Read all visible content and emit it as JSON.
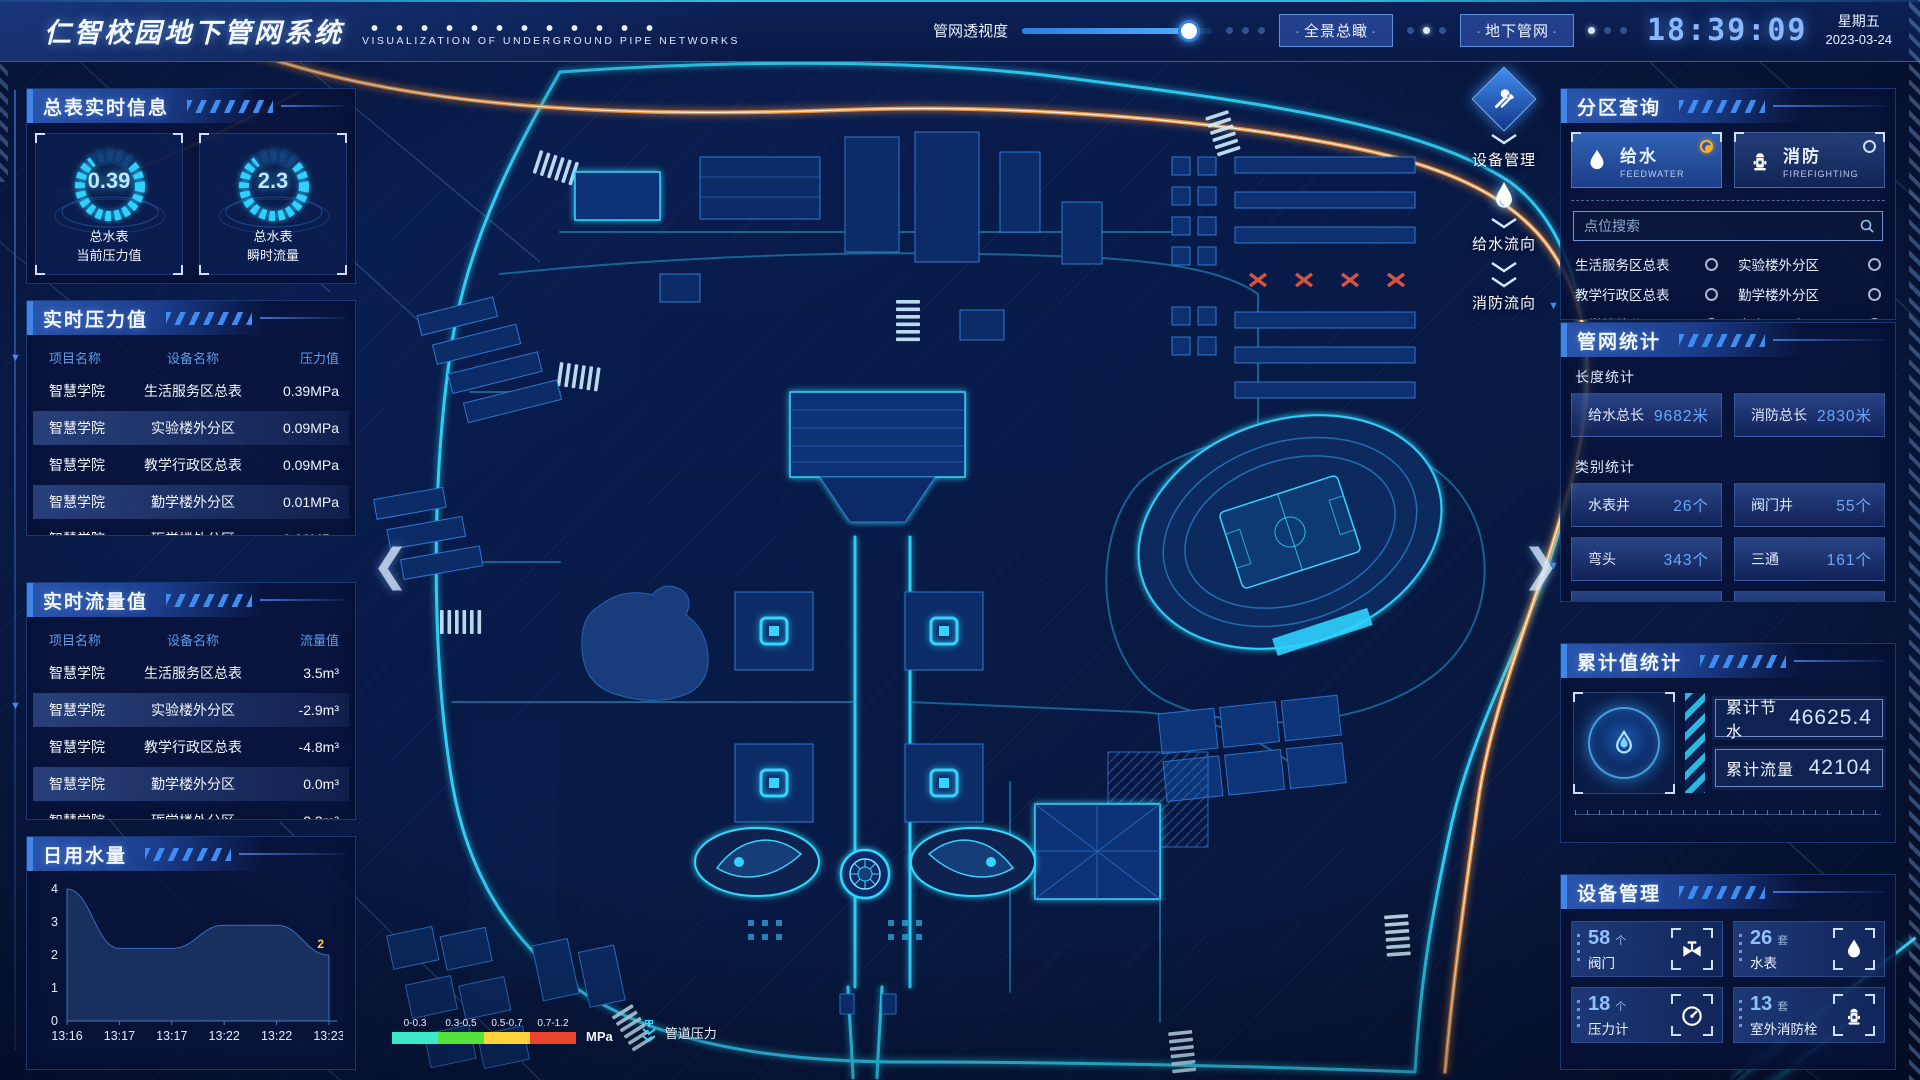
{
  "header": {
    "title": "仁智校园地下管网系统",
    "subtitle": "VISUALIZATION OF UNDERGROUND PIPE NETWORKS",
    "slider_label": "管网透视度",
    "slider_percent": 88,
    "buttons": {
      "panorama": "全景总瞰",
      "underground": "地下管网"
    },
    "clock": "18:39:09",
    "weekday": "星期五",
    "date": "2023-03-24"
  },
  "left": {
    "meters": {
      "title": "总表实时信息",
      "gauges": [
        {
          "value": "0.39",
          "label1": "总水表",
          "label2": "当前压力值"
        },
        {
          "value": "2.3",
          "label1": "总水表",
          "label2": "瞬时流量"
        }
      ]
    },
    "pressure": {
      "title": "实时压力值",
      "headers": [
        "项目名称",
        "设备名称",
        "压力值"
      ],
      "rows": [
        [
          "智慧学院",
          "生活服务区总表",
          "0.39MPa"
        ],
        [
          "智慧学院",
          "实验楼外分区",
          "0.09MPa"
        ],
        [
          "智慧学院",
          "教学行政区总表",
          "0.09MPa"
        ],
        [
          "智慧学院",
          "勤学楼外分区",
          "0.01MPa"
        ],
        [
          "智慧学院",
          "砺学楼外分区",
          "0.00MPa"
        ]
      ]
    },
    "flow": {
      "title": "实时流量值",
      "headers": [
        "项目名称",
        "设备名称",
        "流量值"
      ],
      "rows": [
        [
          "智慧学院",
          "生活服务区总表",
          "3.5m³"
        ],
        [
          "智慧学院",
          "实验楼外分区",
          "-2.9m³"
        ],
        [
          "智慧学院",
          "教学行政区总表",
          "-4.8m³"
        ],
        [
          "智慧学院",
          "勤学楼外分区",
          "0.0m³"
        ],
        [
          "智慧学院",
          "砺学楼外分区",
          "-2.3m³"
        ]
      ]
    },
    "daily": {
      "title": "日用水量"
    }
  },
  "chart_data": {
    "type": "area",
    "title": "日用水量",
    "categories": [
      "13:16",
      "13:17",
      "13:17",
      "13:22",
      "13:22",
      "13:23"
    ],
    "values": [
      4,
      2.2,
      2.2,
      2.9,
      2.9,
      2
    ],
    "ylim": [
      0,
      4
    ],
    "yticks": [
      0,
      1,
      2,
      3,
      4
    ],
    "point_label": {
      "x": "13:23",
      "value": "2"
    }
  },
  "right": {
    "zone": {
      "title": "分区查询",
      "tabs": [
        {
          "label": "给水",
          "sub": "FEEDWATER",
          "selected": true
        },
        {
          "label": "消防",
          "sub": "FIREFIGHTING",
          "selected": false
        }
      ],
      "search_placeholder": "点位搜索",
      "items": [
        "生活服务区总表",
        "实验楼外分区",
        "教学行政区总表",
        "勤学楼外分区",
        "砺学楼外分区",
        "宿舍区泵房"
      ]
    },
    "stats": {
      "title": "管网统计",
      "length_title": "长度统计",
      "length": [
        {
          "label": "给水总长",
          "value": "9682米"
        },
        {
          "label": "消防总长",
          "value": "2830米"
        }
      ],
      "category_title": "类别统计",
      "category": [
        {
          "label": "水表井",
          "value": "26个"
        },
        {
          "label": "阀门井",
          "value": "55个"
        },
        {
          "label": "弯头",
          "value": "343个"
        },
        {
          "label": "三通",
          "value": "161个"
        }
      ]
    },
    "cumulative": {
      "title": "累计值统计",
      "rows": [
        {
          "label": "累计节水",
          "value": "46625.4"
        },
        {
          "label": "累计流量",
          "value": "42104"
        }
      ]
    },
    "devices": {
      "title": "设备管理",
      "cards": [
        {
          "count": "58",
          "unit": "个",
          "label": "阀门",
          "icon": "valve-icon"
        },
        {
          "count": "26",
          "unit": "套",
          "label": "水表",
          "icon": "water-meter-icon"
        },
        {
          "count": "18",
          "unit": "个",
          "label": "压力计",
          "icon": "pressure-gauge-icon"
        },
        {
          "count": "13",
          "unit": "套",
          "label": "室外消防栓",
          "icon": "hydrant-icon"
        }
      ]
    }
  },
  "map": {
    "float_buttons": [
      {
        "label": "设备管理",
        "icon": "tools-icon"
      },
      {
        "label": "给水流向",
        "icon": "water-drop-icon"
      },
      {
        "label": "消防流向",
        "icon": "fire-flow-icon"
      }
    ],
    "legend": {
      "ranges": [
        {
          "label": "0-0.3",
          "color": "#3be8c8"
        },
        {
          "label": "0.3-0.5",
          "color": "#56e23c"
        },
        {
          "label": "0.5-0.7",
          "color": "#ffd43a"
        },
        {
          "label": "0.7-1.2",
          "color": "#e8442e"
        }
      ],
      "unit": "MPa",
      "pressure_label": "管道压力"
    }
  },
  "colors": {
    "accent_cyan": "#27d4ff",
    "accent_orange": "#ff9a3c",
    "radio_selected": "#ffb020",
    "panel_bg": "#0a1c4e"
  }
}
